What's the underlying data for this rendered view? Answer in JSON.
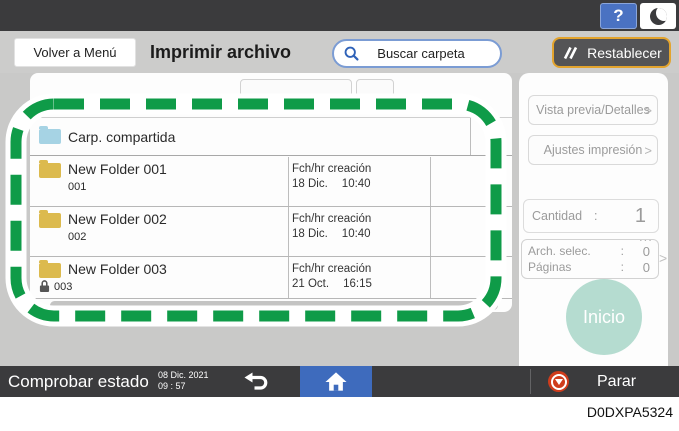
{
  "top_bar": {
    "help": "?"
  },
  "toolbar": {
    "back_button": "Volver a Menú",
    "title": "Imprimir archivo",
    "search_label": "Buscar carpeta",
    "reset_button": "Restablecer"
  },
  "folder_list": {
    "rows": [
      {
        "name": "Carp. compartida",
        "sub": "",
        "meta_label": "",
        "meta_date": "",
        "meta_time": ""
      },
      {
        "name": "New Folder 001",
        "sub": "001",
        "meta_label": "Fch/hr creación",
        "meta_date": "18 Dic.",
        "meta_time": "10:40"
      },
      {
        "name": "New Folder 002",
        "sub": "002",
        "meta_label": "Fch/hr creación",
        "meta_date": "18 Dic.",
        "meta_time": "10:40"
      },
      {
        "name": "New Folder 003",
        "sub": "003",
        "meta_label": "Fch/hr creación",
        "meta_date": "21 Oct.",
        "meta_time": "16:15"
      }
    ]
  },
  "sidebar": {
    "preview_button": "Vista previa/Detalles",
    "print_settings_button": "Ajustes impresión",
    "chevron": ">",
    "quantity_label": "Cantidad",
    "colon": ":",
    "quantity_value": "1",
    "ellipsis": "...",
    "selected_files_label": "Arch. selec.",
    "selected_files_value": "0",
    "pages_label": "Páginas",
    "pages_value": "0",
    "start_button": "Inicio"
  },
  "bottom_bar": {
    "check_status": "Comprobar estado",
    "date": "08 Dic. 2021",
    "time": "09 : 57",
    "stop_label": "Parar"
  },
  "caption": "D0DXPA5324",
  "colors": {
    "accent_blue": "#4a72c2",
    "reset_border": "#e3a42e",
    "annotation_green": "#0f9b48",
    "start_button_disabled": "#b5dcd0",
    "stop_red": "#cf3c1c",
    "folder_yellow": "#dcba4e",
    "folder_shared_blue": "#a6d3e4"
  }
}
